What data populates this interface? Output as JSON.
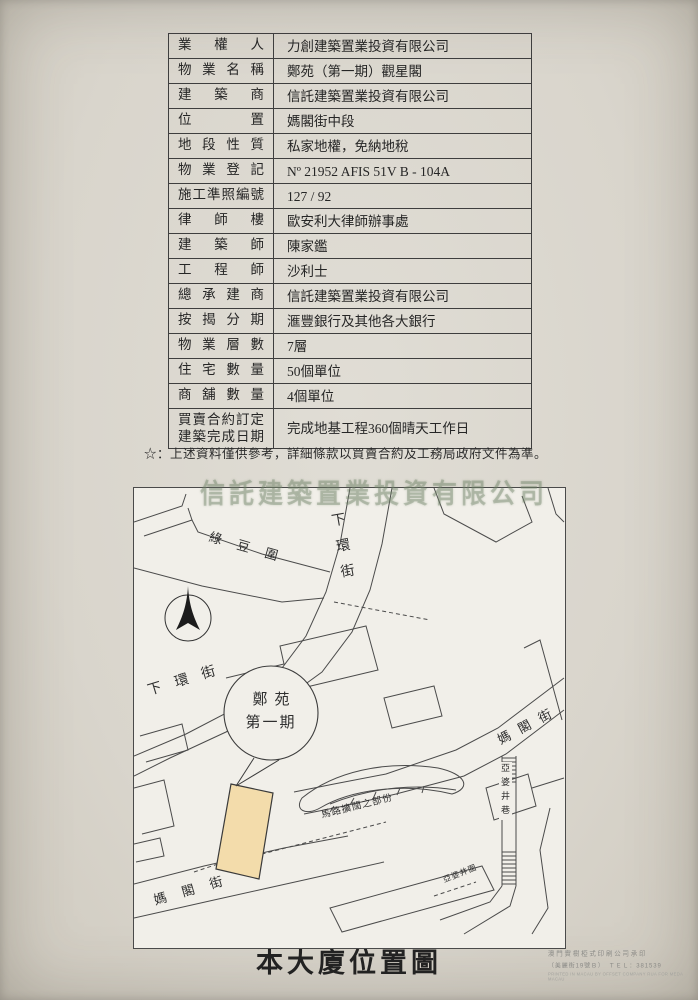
{
  "table": {
    "rows": [
      {
        "label": "業權人",
        "value": "力創建築置業投資有限公司"
      },
      {
        "label": "物業名稱",
        "value": "鄭苑（第一期）觀星閣"
      },
      {
        "label": "建築商",
        "value": "信託建築置業投資有限公司"
      },
      {
        "label": "位置",
        "value": "媽閣街中段"
      },
      {
        "label": "地段性質",
        "value": "私家地權，免納地稅"
      },
      {
        "label": "物業登記",
        "value": "Nº 21952 AFIS 51V B - 104A"
      },
      {
        "label": "施工準照編號",
        "value": "127 / 92"
      },
      {
        "label": "律師樓",
        "value": "歐安利大律師辦事處"
      },
      {
        "label": "建築師",
        "value": "陳家鑑"
      },
      {
        "label": "工程師",
        "value": "沙利士"
      },
      {
        "label": "總承建商",
        "value": "信託建築置業投資有限公司"
      },
      {
        "label": "按揭分期",
        "value": "滙豐銀行及其他各大銀行"
      },
      {
        "label": "物業層數",
        "value": "7層"
      },
      {
        "label": "住宅數量",
        "value": "50個單位"
      },
      {
        "label": "商舖數量",
        "value": "4個單位"
      },
      {
        "label": "買賣合約訂定\n建築完成日期",
        "value": "完成地基工程360個晴天工作日"
      }
    ]
  },
  "note": "☆：上述資料僅供參考，詳細條款以買賣合約及工務局政府文件為準。",
  "ghost_text": "信託建築置業投資有限公司",
  "map": {
    "highlight_color": "#f3dcab",
    "labels": {
      "street_luk_tau_wai": "綠豆圍",
      "street_ha_wan_top": "下環街",
      "street_ha_wan_left": "下環街",
      "street_ma_kok_bottom": "媽閣街",
      "street_ma_kok_right": "媽閣街",
      "lane_a_po_cheng": "亞婆井巷",
      "wai_a_po_cheng": "亞婆井圍",
      "road_widening": "馬路擴闊之部份",
      "building_line1": "鄭苑",
      "building_line2": "第一期"
    }
  },
  "footer": {
    "title": "本大廈位置圖",
    "printer_line1": "澳門實樹椏式印刷公司承印",
    "printer_line2": "（美麗街19號Ｂ）　ＴＥＬ：381539",
    "printer_line3": "PRINTED IN MACAU BY OFFSET COMPANY RUA FOR MEDA MACAU"
  }
}
